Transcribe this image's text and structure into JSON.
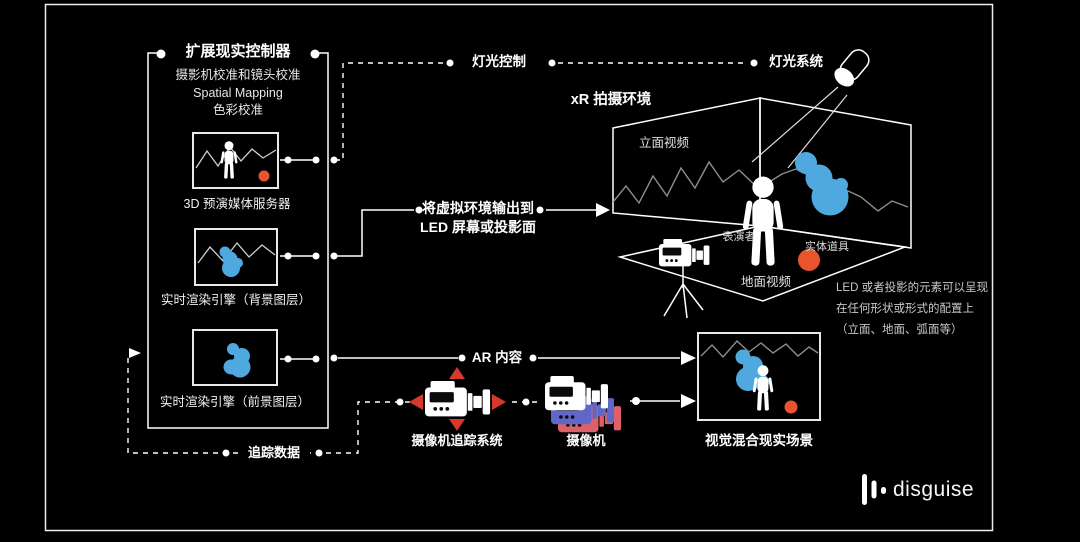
{
  "colors": {
    "background": "#000000",
    "line": "#ffffff",
    "accent_blue": "#4fa8de",
    "accent_orange": "#e8552d",
    "accent_red": "#d6382b",
    "camera_ghost_blue": "#5f68c9",
    "camera_ghost_pink": "#dc6168"
  },
  "controller": {
    "title": "扩展现实控制器",
    "subtitle_lines": [
      "摄影机校准和镜头校准",
      "Spatial Mapping",
      "色彩校准"
    ],
    "nodes": [
      {
        "label": "3D 预演媒体服务器"
      },
      {
        "label": "实时渲染引擎（背景图层）"
      },
      {
        "label": "实时渲染引擎（前景图层）"
      }
    ]
  },
  "flows": {
    "lighting_control": "灯光控制",
    "lighting_system": "灯光系统",
    "led_output": [
      "将虚拟环境输出到",
      "LED 屏幕或投影面"
    ],
    "ar_content": "AR 内容",
    "tracking_data": "追踪数据"
  },
  "stage": {
    "title": "xR 拍摄环境",
    "wall_video": "立面视频",
    "performer": "表演者",
    "physical_prop": "实体道具",
    "floor_video": "地面视频",
    "note_lines": [
      "LED 或者投影的元素可以呈现",
      "在任何形状或形式的配置上",
      "（立面、地面、弧面等）"
    ]
  },
  "capture": {
    "camera_tracking_system": "摄像机追踪系统",
    "camera": "摄像机",
    "composite_scene": "视觉混合现实场景"
  },
  "brand": {
    "name": "disguise"
  }
}
